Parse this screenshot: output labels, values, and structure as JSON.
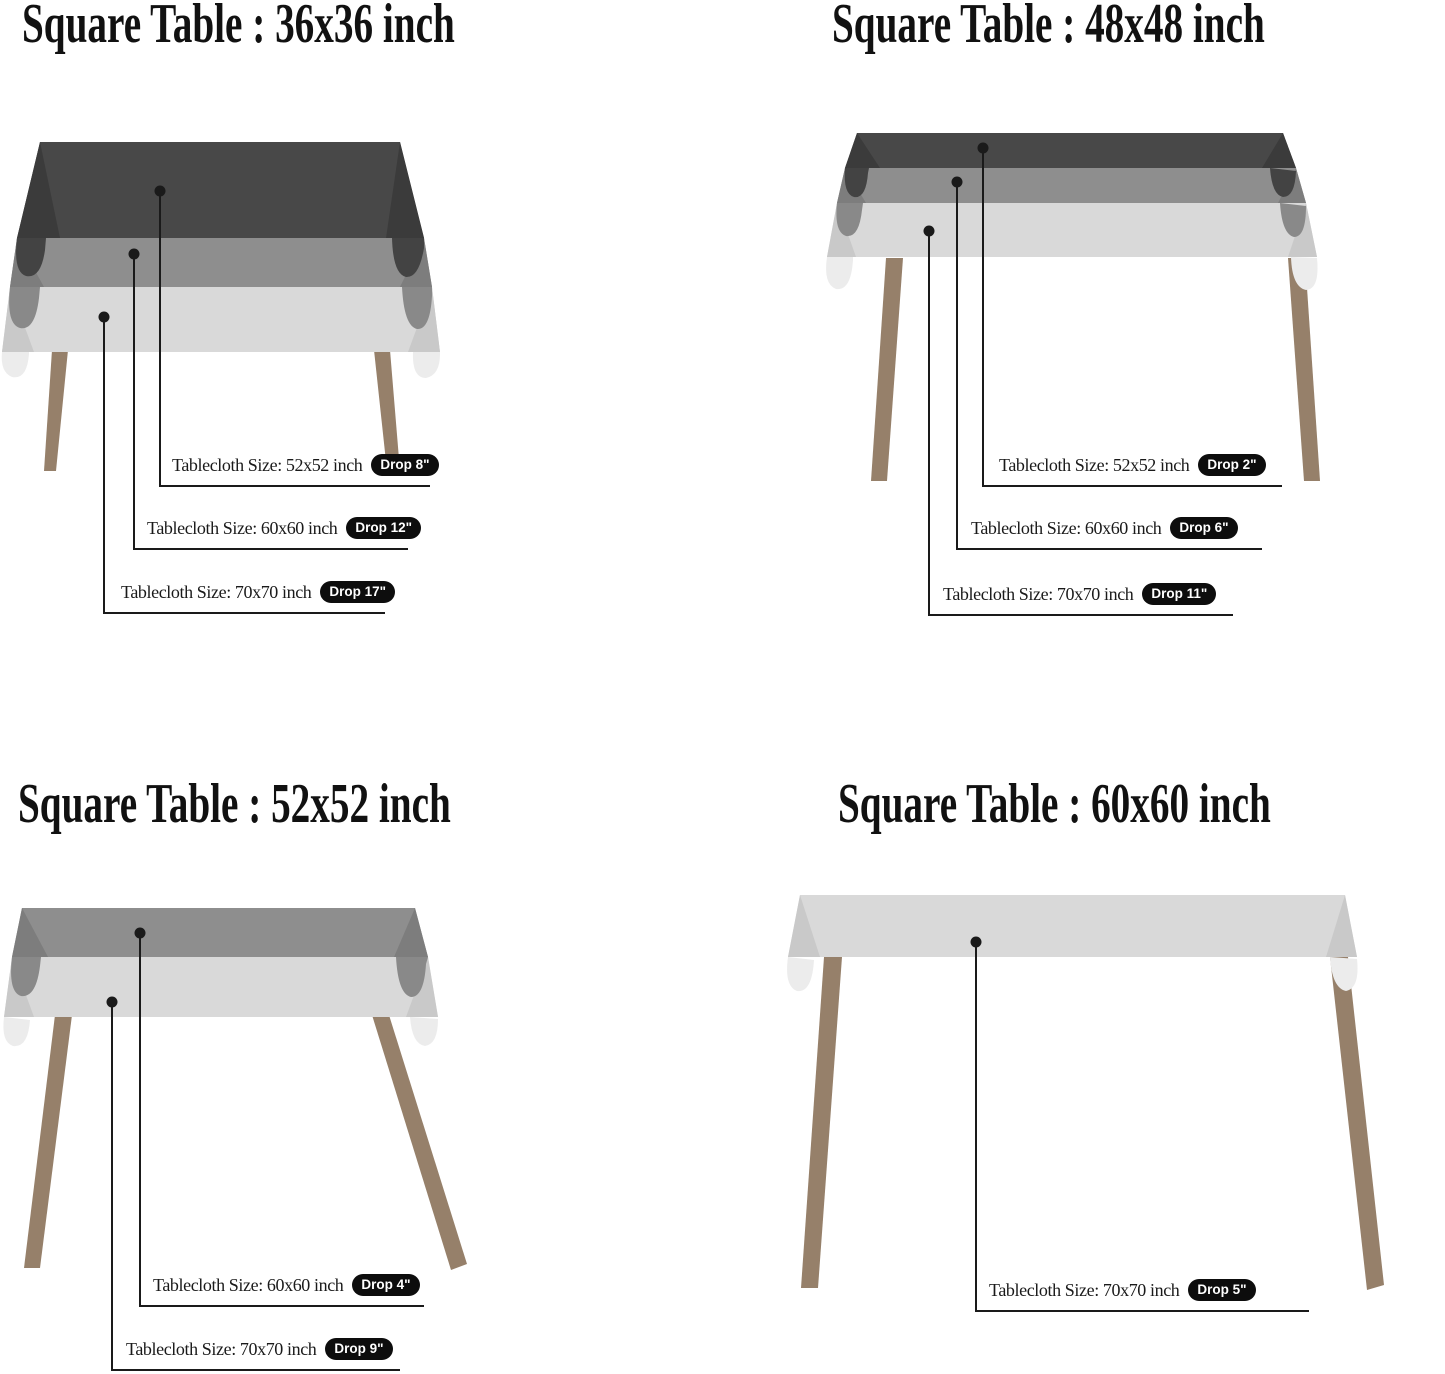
{
  "page": {
    "background": "#ffffff",
    "kind": "tablecloth-size-guide"
  },
  "colors": {
    "page_bg": "#ffffff",
    "title_text": "#111111",
    "label_text": "#1a1a1a",
    "line": "#1a1a1a",
    "badge_bg": "#0d0d0d",
    "badge_text": "#ffffff",
    "cloth_dark": "#484848",
    "cloth_dark_fold": "#3b3b3b",
    "cloth_dark_bump": "#434343",
    "cloth_medium": "#8e8e8e",
    "cloth_medium_fold": "#7d7d7d",
    "cloth_medium_bump": "#898989",
    "cloth_light": "#d9d9d9",
    "cloth_light_fold": "#c9c9c9",
    "cloth_light_flap": "#ececec",
    "leg": "#96806a"
  },
  "quadrants": [
    {
      "id": "36x36",
      "title": "Square Table : 36x36 inch",
      "callouts": [
        {
          "label": "Tablecloth Size: 52x52 inch",
          "badge": "Drop 8\""
        },
        {
          "label": "Tablecloth Size: 60x60 inch",
          "badge": "Drop 12\""
        },
        {
          "label": "Tablecloth Size: 70x70 inch",
          "badge": "Drop 17\""
        }
      ]
    },
    {
      "id": "48x48",
      "title": "Square Table : 48x48 inch",
      "callouts": [
        {
          "label": "Tablecloth Size: 52x52 inch",
          "badge": "Drop 2\""
        },
        {
          "label": "Tablecloth Size: 60x60 inch",
          "badge": "Drop 6\""
        },
        {
          "label": "Tablecloth Size: 70x70 inch",
          "badge": "Drop 11\""
        }
      ]
    },
    {
      "id": "52x52",
      "title": "Square Table : 52x52 inch",
      "callouts": [
        {
          "label": "Tablecloth Size: 60x60 inch",
          "badge": "Drop 4\""
        },
        {
          "label": "Tablecloth Size: 70x70 inch",
          "badge": "Drop 9\""
        }
      ]
    },
    {
      "id": "60x60",
      "title": "Square Table : 60x60 inch",
      "callouts": [
        {
          "label": "Tablecloth Size: 70x70 inch",
          "badge": "Drop 5\""
        }
      ]
    }
  ]
}
